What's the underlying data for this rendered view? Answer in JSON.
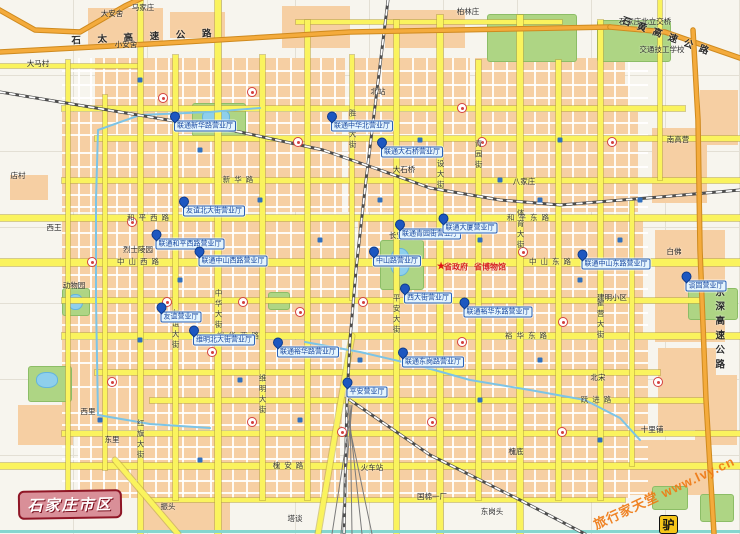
{
  "map": {
    "plate_text": "石家庄市区",
    "watermark": {
      "text": "旅行家天堂 www.lvy.cn",
      "logo_char": "驴"
    },
    "colors": {
      "block": "#f6cfa3",
      "major_road": "#faf35e",
      "expressway": "#f4ab3c",
      "park": "#aed584",
      "lake": "#8ecfec",
      "poi_blue": "#1d57c0",
      "plate_bg": "#d98f98",
      "watermark_orange": "#ef7a14",
      "red_accent": "#d62020"
    },
    "geometry": {
      "blocks": [
        [
          88,
          8,
          75,
          38
        ],
        [
          170,
          12,
          55,
          26
        ],
        [
          282,
          6,
          68,
          42
        ],
        [
          385,
          10,
          80,
          38
        ],
        [
          95,
          58,
          250,
          48
        ],
        [
          350,
          58,
          120,
          48
        ],
        [
          475,
          58,
          150,
          48
        ],
        [
          62,
          112,
          280,
          100
        ],
        [
          348,
          112,
          290,
          100
        ],
        [
          62,
          218,
          290,
          115
        ],
        [
          358,
          218,
          285,
          115
        ],
        [
          62,
          340,
          280,
          90
        ],
        [
          348,
          340,
          300,
          92
        ],
        [
          80,
          436,
          260,
          62
        ],
        [
          348,
          436,
          280,
          62
        ],
        [
          652,
          128,
          55,
          75
        ],
        [
          655,
          230,
          70,
          112
        ],
        [
          658,
          348,
          58,
          82
        ],
        [
          620,
          440,
          90,
          55
        ],
        [
          560,
          85,
          70,
          45
        ],
        [
          140,
          498,
          90,
          32
        ],
        [
          10,
          175,
          38,
          25
        ],
        [
          18,
          405,
          55,
          40
        ],
        [
          695,
          375,
          42,
          70
        ],
        [
          700,
          90,
          38,
          55
        ]
      ],
      "minor_v_extent": [
        58,
        498
      ],
      "minor_v": [
        78,
        90,
        103,
        116,
        129,
        155,
        168,
        182,
        196,
        210,
        232,
        246,
        276,
        290,
        320,
        334,
        366,
        380,
        412,
        426,
        452,
        466,
        492,
        506,
        534,
        548,
        572,
        586,
        614,
        628
      ],
      "minor_h_extent": [
        62,
        648
      ],
      "minor_h": [
        70,
        84,
        97,
        122,
        134,
        152,
        166,
        194,
        206,
        232,
        246,
        274,
        288,
        312,
        324,
        350,
        362,
        386,
        412,
        424,
        446,
        458,
        480,
        492
      ],
      "roads_h": [
        [
          22,
          296,
          562,
          4
        ],
        [
          66,
          0,
          140,
          4
        ],
        [
          108,
          62,
          685,
          5
        ],
        [
          138,
          95,
          740,
          5
        ],
        [
          180,
          62,
          740,
          5
        ],
        [
          218,
          0,
          740,
          6
        ],
        [
          262,
          0,
          740,
          7
        ],
        [
          300,
          62,
          700,
          5
        ],
        [
          336,
          62,
          740,
          6
        ],
        [
          372,
          95,
          660,
          5
        ],
        [
          400,
          150,
          705,
          5
        ],
        [
          433,
          62,
          740,
          5
        ],
        [
          466,
          0,
          740,
          6
        ],
        [
          500,
          150,
          625,
          4
        ]
      ],
      "roads_v": [
        [
          68,
          60,
          500,
          4
        ],
        [
          105,
          95,
          470,
          4
        ],
        [
          140,
          0,
          534,
          5
        ],
        [
          175,
          55,
          500,
          5
        ],
        [
          218,
          0,
          534,
          6
        ],
        [
          262,
          55,
          500,
          5
        ],
        [
          307,
          20,
          500,
          5
        ],
        [
          352,
          55,
          300,
          4
        ],
        [
          396,
          20,
          534,
          5
        ],
        [
          440,
          15,
          534,
          6
        ],
        [
          478,
          60,
          500,
          5
        ],
        [
          520,
          15,
          534,
          6
        ],
        [
          558,
          60,
          500,
          5
        ],
        [
          600,
          20,
          500,
          5
        ],
        [
          632,
          200,
          466,
          4
        ],
        [
          660,
          0,
          180,
          4
        ]
      ],
      "road_diagonals": [
        [
          115,
          460,
          178,
          534
        ],
        [
          352,
          336,
          318,
          534
        ]
      ],
      "teal_road": [
        530,
        0,
        740,
        3
      ],
      "expressways": [
        [
          [
            0,
            52
          ],
          [
            150,
            44
          ],
          [
            350,
            32
          ],
          [
            610,
            27
          ]
        ],
        [
          [
            610,
            27
          ],
          [
            665,
            32
          ],
          [
            740,
            58
          ]
        ],
        [
          [
            693,
            30
          ],
          [
            698,
            120
          ],
          [
            700,
            250
          ],
          [
            706,
            400
          ],
          [
            714,
            534
          ]
        ],
        [
          [
            -4,
            8
          ],
          [
            35,
            30
          ],
          [
            80,
            32
          ],
          [
            125,
            6
          ],
          [
            142,
            -2
          ]
        ]
      ],
      "railways": [
        [
          [
            388,
            0
          ],
          [
            377,
            90
          ],
          [
            366,
            180
          ],
          [
            356,
            270
          ],
          [
            350,
            340
          ],
          [
            347,
            400
          ],
          [
            344,
            534
          ]
        ],
        [
          [
            0,
            92
          ],
          [
            120,
            112
          ],
          [
            240,
            132
          ],
          [
            323,
            150
          ],
          [
            380,
            170
          ],
          [
            430,
            188
          ],
          [
            500,
            200
          ],
          [
            560,
            205
          ],
          [
            660,
            197
          ],
          [
            740,
            190
          ]
        ],
        [
          [
            350,
            400
          ],
          [
            430,
            455
          ],
          [
            520,
            500
          ],
          [
            585,
            534
          ]
        ]
      ],
      "rail_yard": [
        [
          352,
          405,
          332,
          534
        ],
        [
          352,
          405,
          341,
          534
        ],
        [
          350,
          405,
          352,
          534
        ],
        [
          348,
          405,
          362,
          534
        ],
        [
          346,
          410,
          372,
          534
        ]
      ],
      "canals": [
        [
          [
            98,
            415
          ],
          [
            96,
            300
          ],
          [
            96,
            200
          ],
          [
            98,
            130
          ],
          [
            140,
            115
          ],
          [
            210,
            112
          ],
          [
            260,
            108
          ]
        ],
        [
          [
            305,
            342
          ],
          [
            360,
            352
          ],
          [
            420,
            366
          ],
          [
            470,
            380
          ],
          [
            530,
            390
          ],
          [
            585,
            400
          ],
          [
            620,
            418
          ],
          [
            640,
            440
          ]
        ],
        [
          [
            98,
            415
          ],
          [
            150,
            424
          ],
          [
            210,
            428
          ]
        ]
      ],
      "parks": [
        [
          192,
          103,
          52,
          32
        ],
        [
          380,
          240,
          42,
          48
        ],
        [
          28,
          366,
          42,
          34
        ],
        [
          62,
          288,
          26,
          26
        ],
        [
          487,
          14,
          88,
          46
        ],
        [
          597,
          20,
          72,
          40
        ],
        [
          688,
          288,
          48,
          30
        ],
        [
          652,
          486,
          34,
          22
        ],
        [
          700,
          494,
          32,
          26
        ],
        [
          268,
          292,
          20,
          16
        ]
      ],
      "lakes": [
        [
          202,
          108,
          26,
          16
        ],
        [
          390,
          248,
          18,
          26
        ],
        [
          36,
          372,
          20,
          14
        ],
        [
          68,
          294,
          13,
          14
        ]
      ],
      "icons_red": [
        [
          163,
          98
        ],
        [
          252,
          92
        ],
        [
          298,
          142
        ],
        [
          132,
          222
        ],
        [
          92,
          262
        ],
        [
          167,
          302
        ],
        [
          243,
          302
        ],
        [
          300,
          312
        ],
        [
          363,
          302
        ],
        [
          462,
          342
        ],
        [
          523,
          252
        ],
        [
          563,
          322
        ],
        [
          482,
          142
        ],
        [
          612,
          142
        ],
        [
          342,
          432
        ],
        [
          432,
          422
        ],
        [
          562,
          432
        ],
        [
          252,
          422
        ],
        [
          112,
          382
        ],
        [
          658,
          382
        ],
        [
          462,
          108
        ],
        [
          212,
          352
        ]
      ],
      "icons_blue": [
        [
          140,
          80
        ],
        [
          200,
          150
        ],
        [
          260,
          200
        ],
        [
          320,
          240
        ],
        [
          380,
          200
        ],
        [
          420,
          140
        ],
        [
          480,
          240
        ],
        [
          540,
          200
        ],
        [
          580,
          280
        ],
        [
          620,
          240
        ],
        [
          180,
          280
        ],
        [
          240,
          380
        ],
        [
          300,
          420
        ],
        [
          360,
          360
        ],
        [
          420,
          300
        ],
        [
          480,
          400
        ],
        [
          540,
          360
        ],
        [
          600,
          440
        ],
        [
          140,
          340
        ],
        [
          100,
          420
        ],
        [
          500,
          180
        ],
        [
          560,
          140
        ],
        [
          640,
          200
        ],
        [
          200,
          460
        ]
      ]
    },
    "labels": {
      "places": [
        {
          "t": "大安舍",
          "x": 112,
          "y": 14
        },
        {
          "t": "马家庄",
          "x": 143,
          "y": 8
        },
        {
          "t": "小安舍",
          "x": 126,
          "y": 45
        },
        {
          "t": "大马村",
          "x": 38,
          "y": 64
        },
        {
          "t": "店村",
          "x": 18,
          "y": 176
        },
        {
          "t": "西王",
          "x": 54,
          "y": 228
        },
        {
          "t": "动物园",
          "x": 74,
          "y": 286
        },
        {
          "t": "振头",
          "x": 168,
          "y": 507
        },
        {
          "t": "塔谈",
          "x": 295,
          "y": 519
        },
        {
          "t": "东岗头",
          "x": 492,
          "y": 512
        },
        {
          "t": "槐底",
          "x": 516,
          "y": 452
        },
        {
          "t": "十里铺",
          "x": 652,
          "y": 430
        },
        {
          "t": "北宋",
          "x": 598,
          "y": 378
        },
        {
          "t": "白佛",
          "x": 674,
          "y": 252
        },
        {
          "t": "建明小区",
          "x": 612,
          "y": 298
        },
        {
          "t": "南高营",
          "x": 678,
          "y": 140
        },
        {
          "t": "交通技工学校",
          "x": 662,
          "y": 50
        },
        {
          "t": "石家庄北立交桥",
          "x": 645,
          "y": 22
        },
        {
          "t": "北站",
          "x": 378,
          "y": 92
        },
        {
          "t": "大石桥",
          "x": 404,
          "y": 170
        },
        {
          "t": "长安公园",
          "x": 404,
          "y": 236
        },
        {
          "t": "火车站",
          "x": 372,
          "y": 468
        },
        {
          "t": "国棉一厂",
          "x": 432,
          "y": 497
        },
        {
          "t": "烈士陵园",
          "x": 138,
          "y": 250
        },
        {
          "t": "柏林庄",
          "x": 468,
          "y": 12
        },
        {
          "t": "八家庄",
          "x": 524,
          "y": 182
        },
        {
          "t": "东里",
          "x": 112,
          "y": 440
        },
        {
          "t": "西里",
          "x": 88,
          "y": 412
        }
      ],
      "streets_h": [
        {
          "t": "新华路",
          "x": 240,
          "y": 180
        },
        {
          "t": "和平西路",
          "x": 150,
          "y": 218
        },
        {
          "t": "和平东路",
          "x": 530,
          "y": 218
        },
        {
          "t": "中山西路",
          "x": 140,
          "y": 262
        },
        {
          "t": "中山东路",
          "x": 552,
          "y": 262
        },
        {
          "t": "裕华西路",
          "x": 240,
          "y": 336
        },
        {
          "t": "裕华东路",
          "x": 528,
          "y": 336
        },
        {
          "t": "槐安路",
          "x": 290,
          "y": 466
        },
        {
          "t": "跃进路",
          "x": 598,
          "y": 400
        }
      ],
      "streets_v": [
        {
          "t": "中华大街",
          "x": 218,
          "y": 310
        },
        {
          "t": "友谊大街",
          "x": 175,
          "y": 330
        },
        {
          "t": "红旗大街",
          "x": 140,
          "y": 440
        },
        {
          "t": "维明大街",
          "x": 262,
          "y": 395
        },
        {
          "t": "胜利大街",
          "x": 352,
          "y": 130
        },
        {
          "t": "平安大街",
          "x": 396,
          "y": 315
        },
        {
          "t": "建设大街",
          "x": 440,
          "y": 170
        },
        {
          "t": "青园街",
          "x": 478,
          "y": 155
        },
        {
          "t": "体育大街",
          "x": 520,
          "y": 230
        },
        {
          "t": "翟营大街",
          "x": 600,
          "y": 320
        }
      ],
      "expressways": [
        {
          "t": "石 太 高 速 公 路",
          "x": 145,
          "y": 38,
          "rot": -3,
          "vert": false
        },
        {
          "t": "石黄高速公路",
          "x": 668,
          "y": 38,
          "rot": 20,
          "vert": false
        },
        {
          "t": "京深高速公路",
          "x": 718,
          "y": 330,
          "rot": 0,
          "vert": true
        }
      ],
      "red": [
        {
          "t": "省政府",
          "x": 456,
          "y": 268
        },
        {
          "t": "省博物馆",
          "x": 490,
          "y": 268
        }
      ],
      "star": {
        "x": 441,
        "y": 267,
        "glyph": "★"
      }
    },
    "pois": [
      {
        "t": "联通新华路营业厅",
        "x": 205,
        "y": 126
      },
      {
        "t": "联通中华北营业厅",
        "x": 362,
        "y": 126
      },
      {
        "t": "联通大石桥营业厅",
        "x": 412,
        "y": 152
      },
      {
        "t": "友谊北大街营业厅",
        "x": 214,
        "y": 211
      },
      {
        "t": "联通和平西路营业厅",
        "x": 190,
        "y": 244
      },
      {
        "t": "联通青园街营业厅",
        "x": 430,
        "y": 234
      },
      {
        "t": "联通大厦营业厅",
        "x": 470,
        "y": 228
      },
      {
        "t": "联通中山西路营业厅",
        "x": 233,
        "y": 261
      },
      {
        "t": "中山路营业厅",
        "x": 397,
        "y": 261
      },
      {
        "t": "联通中山东路营业厅",
        "x": 616,
        "y": 264
      },
      {
        "t": "西大街营业厅",
        "x": 428,
        "y": 298
      },
      {
        "t": "联通裕华东路营业厅",
        "x": 498,
        "y": 312
      },
      {
        "t": "友谊营业厅",
        "x": 181,
        "y": 317
      },
      {
        "t": "维明北大街营业厅",
        "x": 224,
        "y": 340
      },
      {
        "t": "联通裕华路营业厅",
        "x": 308,
        "y": 352
      },
      {
        "t": "联通东岗路营业厅",
        "x": 433,
        "y": 362
      },
      {
        "t": "平安营业厅",
        "x": 367,
        "y": 392
      },
      {
        "t": "谈固营业厅",
        "x": 706,
        "y": 286
      }
    ]
  }
}
